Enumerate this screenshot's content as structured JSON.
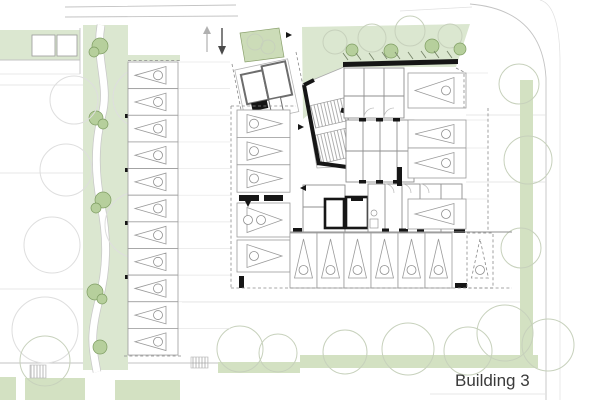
{
  "label": {
    "building": "Building 3"
  },
  "annotations": {
    "ramp_up_arrow": "up-arrow",
    "ramp_down_arrow": "down-arrow",
    "stall_symbol": "triangle-with-circle-marker"
  },
  "parking": {
    "total_stalls": 27,
    "groups": [
      {
        "id": "left-column",
        "count": 11,
        "direction": "left"
      },
      {
        "id": "middle-upper",
        "count": 3,
        "direction": "right"
      },
      {
        "id": "middle-lower",
        "count": 2,
        "direction": "right",
        "accessible_first": true
      },
      {
        "id": "right-column",
        "count": 4,
        "direction": "left"
      },
      {
        "id": "bottom-row",
        "count": 6,
        "direction": "up"
      },
      {
        "id": "bottom-row-dashed",
        "count": 1,
        "direction": "up",
        "dashed": true
      }
    ]
  },
  "colors": {
    "background": "#ffffff",
    "landscape_green": "#dbe7d0",
    "hedge_green": "#d3e1c2",
    "shrub_green": "#b6cf9c",
    "shrub_outline": "#7e9d62",
    "wall_black": "#161616",
    "line_gray": "#8f8f8f",
    "text": "#3a3a3a"
  }
}
